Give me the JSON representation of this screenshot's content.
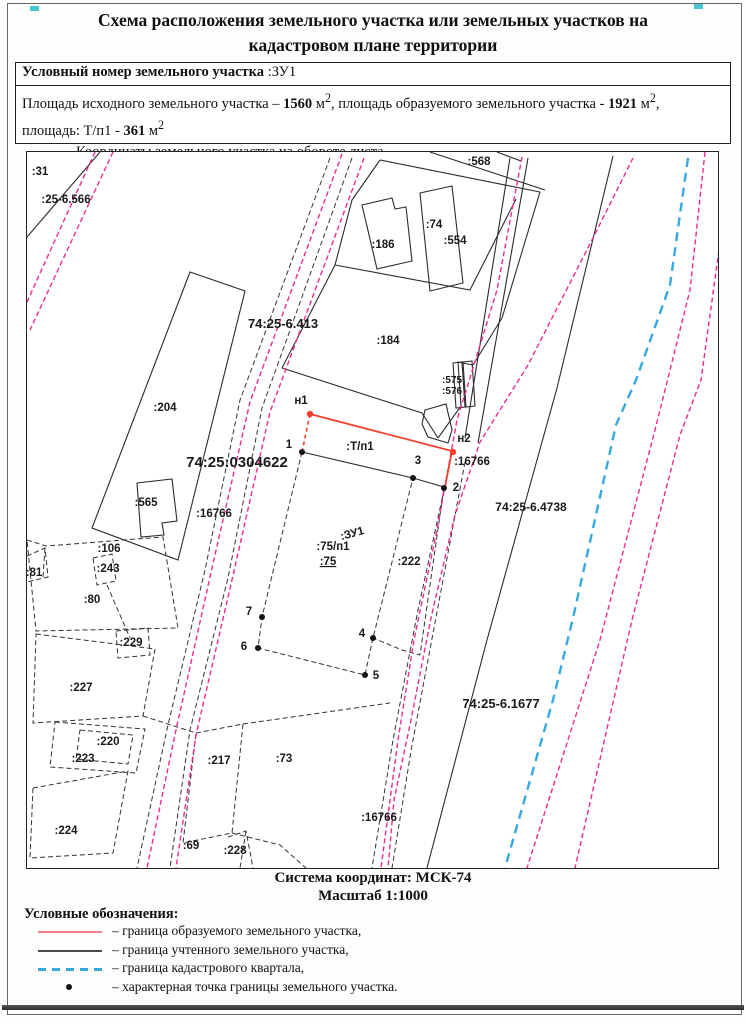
{
  "title_line1": "Схема расположения земельного участка или земельных участков на",
  "title_line2": "кадастровом плане территории",
  "header_box": {
    "row1_label": "Условный номер земельного участка",
    "row1_value": " :ЗУ1",
    "row2_segments": [
      {
        "t": "Площадь исходного земельного участка – "
      },
      {
        "t": "1560",
        "b": true
      },
      {
        "t": " м"
      },
      {
        "t": "2",
        "sup": true
      },
      {
        "t": ", площадь образуемого земельного участка - "
      },
      {
        "t": "1921",
        "b": true
      },
      {
        "t": " м"
      },
      {
        "t": "2",
        "sup": true
      },
      {
        "t": ","
      },
      {
        "br": true
      },
      {
        "t": "площадь: Т/п1 - "
      },
      {
        "t": "361",
        "b": true
      },
      {
        "t": " м"
      },
      {
        "t": "2",
        "sup": true
      }
    ],
    "row3_text": "Координаты земельного участка на обороте листа"
  },
  "map": {
    "labels": [
      {
        "t": ":31",
        "x": 40,
        "y": 175
      },
      {
        "t": ":25-6.566",
        "x": 66,
        "y": 203
      },
      {
        "t": ":568",
        "x": 479,
        "y": 165
      },
      {
        "t": ":186",
        "x": 383,
        "y": 248
      },
      {
        "t": ":74",
        "x": 434,
        "y": 228
      },
      {
        "t": ":554",
        "x": 455,
        "y": 244
      },
      {
        "t": "74:25-6.413",
        "x": 283,
        "y": 328,
        "fs": 13
      },
      {
        "t": ":184",
        "x": 388,
        "y": 344
      },
      {
        "t": ":204",
        "x": 165,
        "y": 411
      },
      {
        "t": ":575",
        "x": 452,
        "y": 383,
        "fs": 10
      },
      {
        "t": ":576",
        "x": 452,
        "y": 394,
        "fs": 10
      },
      {
        "t": "н1",
        "x": 301,
        "y": 404
      },
      {
        "t": "1",
        "x": 289,
        "y": 448
      },
      {
        "t": ":Т/п1",
        "x": 360,
        "y": 450
      },
      {
        "t": "н2",
        "x": 464,
        "y": 442
      },
      {
        "t": "3",
        "x": 418,
        "y": 464
      },
      {
        "t": "74:25:0304622",
        "x": 237,
        "y": 467,
        "fs": 15
      },
      {
        "t": ":16766",
        "x": 472,
        "y": 465
      },
      {
        "t": "2",
        "x": 456,
        "y": 491
      },
      {
        "t": ":565",
        "x": 146,
        "y": 506
      },
      {
        "t": ":16766",
        "x": 214,
        "y": 517
      },
      {
        "t": "74:25-6.4738",
        "x": 531,
        "y": 511,
        "fs": 12
      },
      {
        "t": ":106",
        "x": 109,
        "y": 552
      },
      {
        "t": ":243",
        "x": 108,
        "y": 572
      },
      {
        "t": ":81",
        "x": 34,
        "y": 576
      },
      {
        "t": ":80",
        "x": 92,
        "y": 603
      },
      {
        "t": ":ЗУ1",
        "x": 353,
        "y": 537,
        "rot": -15
      },
      {
        "t": ":75/п1",
        "x": 333,
        "y": 550
      },
      {
        "t": ":75",
        "x": 328,
        "y": 565,
        "u": true
      },
      {
        "t": ":222",
        "x": 409,
        "y": 565
      },
      {
        "t": "7",
        "x": 249,
        "y": 615
      },
      {
        "t": "6",
        "x": 244,
        "y": 650
      },
      {
        "t": ":229",
        "x": 131,
        "y": 646
      },
      {
        "t": "4",
        "x": 362,
        "y": 637
      },
      {
        "t": "5",
        "x": 376,
        "y": 679
      },
      {
        "t": ":227",
        "x": 81,
        "y": 691
      },
      {
        "t": "74:25-6.1677",
        "x": 501,
        "y": 708,
        "fs": 13
      },
      {
        "t": ":220",
        "x": 108,
        "y": 745
      },
      {
        "t": ":223",
        "x": 83,
        "y": 762
      },
      {
        "t": ":217",
        "x": 219,
        "y": 764
      },
      {
        "t": ":73",
        "x": 284,
        "y": 762
      },
      {
        "t": ":16766",
        "x": 379,
        "y": 821
      },
      {
        "t": ":224",
        "x": 66,
        "y": 834
      },
      {
        "t": ":69",
        "x": 191,
        "y": 849
      },
      {
        "t": ":228",
        "x": 235,
        "y": 854
      }
    ],
    "points": [
      {
        "n": "н1",
        "x": 310,
        "y": 414,
        "c": "red"
      },
      {
        "n": "н2",
        "x": 453,
        "y": 452,
        "c": "red"
      },
      {
        "n": "1",
        "x": 302,
        "y": 452,
        "c": "black"
      },
      {
        "n": "2",
        "x": 444,
        "y": 488,
        "c": "black"
      },
      {
        "n": "3",
        "x": 413,
        "y": 478,
        "c": "black"
      },
      {
        "n": "4",
        "x": 373,
        "y": 638,
        "c": "black"
      },
      {
        "n": "5",
        "x": 365,
        "y": 675,
        "c": "black"
      },
      {
        "n": "6",
        "x": 258,
        "y": 648,
        "c": "black"
      },
      {
        "n": "7",
        "x": 262,
        "y": 617,
        "c": "black"
      }
    ],
    "footer_line1": "Система координат: МСК-74",
    "footer_line2": "Масштаб 1:1000"
  },
  "legend": {
    "title": "Условные обозначения:",
    "items": [
      {
        "swatch": "red-line",
        "label": "– граница образуемого земельного участка,"
      },
      {
        "swatch": "black-line",
        "label": "– граница учтенного земельного участка,"
      },
      {
        "swatch": "blue-dashed",
        "label": "– граница кадастрового квартала,"
      },
      {
        "swatch": "black-dot",
        "label": "– характерная точка границы земельного участка."
      }
    ]
  },
  "colors": {
    "magenta": "#ec2c92",
    "red_boundary": "#f5402e",
    "blue_quarter": "#36a9de",
    "black_line": "#2b2b2b",
    "legend_red": "#ef8089"
  }
}
